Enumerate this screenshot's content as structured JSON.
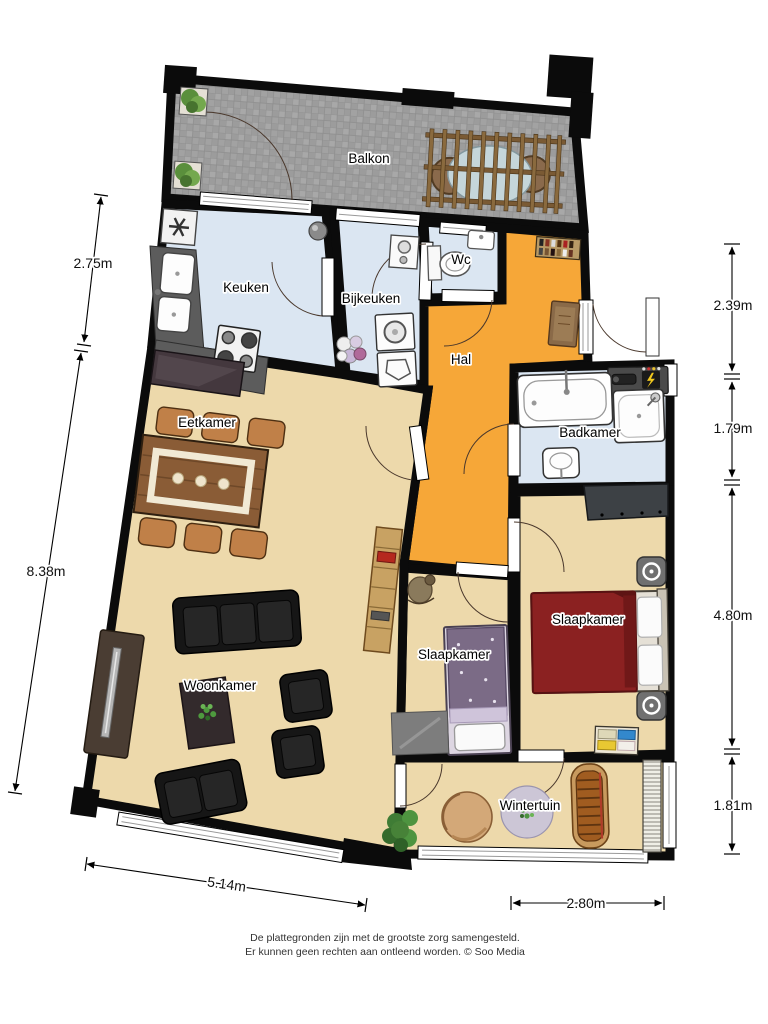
{
  "rooms": {
    "balkon": {
      "label": "Balkon"
    },
    "keuken": {
      "label": "Keuken"
    },
    "bijkeuken": {
      "label": "Bijkeuken"
    },
    "wc": {
      "label": "Wc"
    },
    "hal": {
      "label": "Hal"
    },
    "eetkamer": {
      "label": "Eetkamer"
    },
    "badkamer": {
      "label": "Badkamer"
    },
    "woonkamer": {
      "label": "Woonkamer"
    },
    "slaapkamer_links": {
      "label": "Slaapkamer"
    },
    "slaapkamer_rechts": {
      "label": "Slaapkamer"
    },
    "wintertuin": {
      "label": "Wintertuin"
    }
  },
  "dimensions": {
    "left_top": {
      "label": "2.75m"
    },
    "left_main": {
      "label": "8.38m"
    },
    "right_1": {
      "label": "2.39m"
    },
    "right_2": {
      "label": "1.79m"
    },
    "right_3": {
      "label": "4.80m"
    },
    "right_4": {
      "label": "1.81m"
    },
    "bottom_left": {
      "label": "5.14m"
    },
    "bottom_right": {
      "label": "2.80m"
    }
  },
  "footer": {
    "line1": "De plattegronden zijn met de grootste zorg samengesteld.",
    "line2": "Er kunnen geen rechten aan ontleend worden. © Soo Media"
  },
  "colors": {
    "wall": "#0b0b0b",
    "floor_living": "#edd9ab",
    "floor_wet": "#dbe6f2",
    "floor_hal": "#f6a738",
    "floor_balkon": "#9c9c9c",
    "bed_red": "#8b2121",
    "bed_purple": "#7b6b86"
  }
}
